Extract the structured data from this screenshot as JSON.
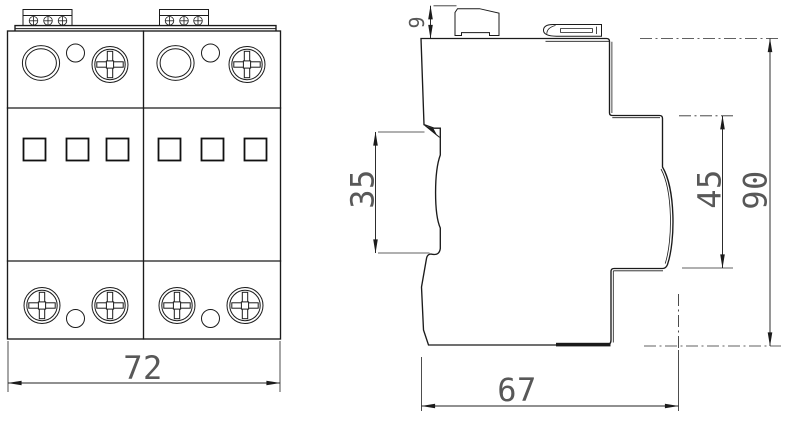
{
  "drawing": {
    "type": "technical-dimension-drawing",
    "background": "#ffffff",
    "line_color": "#1b1b1b",
    "dim_text_color": "#585858"
  },
  "views": {
    "front": {
      "name": "front-view",
      "module_count": 2,
      "windows_per_module": 3,
      "dims": {
        "width": "72"
      }
    },
    "side": {
      "name": "side-view",
      "dims": {
        "terminal_height": "9",
        "rail_slot_height": "35",
        "upper_step_height": "45",
        "overall_height": "90",
        "overall_depth": "67"
      }
    }
  }
}
